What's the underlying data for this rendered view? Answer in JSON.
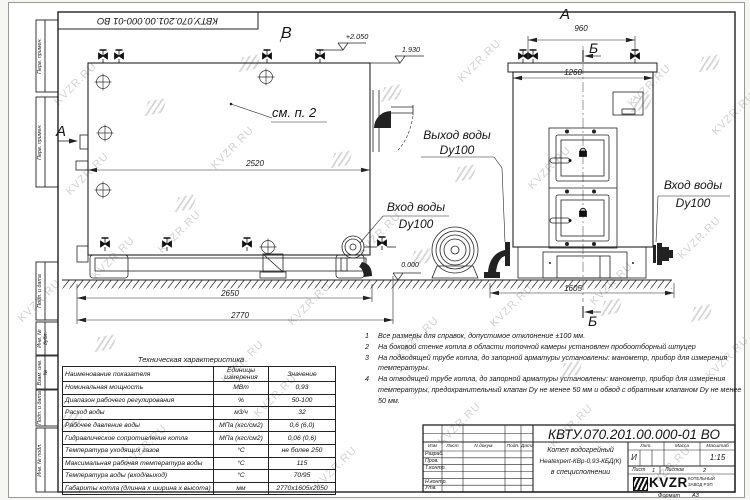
{
  "watermark": {
    "text": "KVZR.RU"
  },
  "sheet": {
    "top_stamp": "КВТУ.070.201.00.000-01 ВО",
    "margin_top": [
      "Перв. примен.",
      "Перв. примен."
    ],
    "margin_bottom": [
      "Подп. и дата",
      "Инв. № дубл.",
      "Взам. инв. №",
      "Подп. и дата",
      "Инв. № подл."
    ],
    "format_label": "Формат",
    "format_value": "А3"
  },
  "drawing": {
    "labels": {
      "view_a_left": "А",
      "view_b": "В",
      "view_a_top": "А",
      "cut_b_top": "Б",
      "cut_b_bottom": "Б",
      "see_note": "см. п. 2"
    },
    "elev": {
      "top": "+2.050",
      "mid": "1.930",
      "zero": "0.000"
    },
    "callouts": {
      "outlet_l1": "Выход воды",
      "outlet_l2": "Dy100",
      "inlet_left_l1": "Вход воды",
      "inlet_left_l2": "Dy100",
      "inlet_right_l1": "Вход воды",
      "inlet_right_l2": "Dy100"
    },
    "dims": {
      "d2520": "2520",
      "d2650": "2650",
      "d2770": "2770",
      "d960": "960",
      "d1260": "1260",
      "d1605": "1605"
    }
  },
  "notes": [
    {
      "num": "1",
      "text": "Все размеры для справок, допустимое отклонение  ±100 мм."
    },
    {
      "num": "2",
      "text": "На боковой стенке котла в области топочной камеры установлен пробоотборный штуцер"
    },
    {
      "num": "3",
      "text": "На  подводящей трубе котла, до запорной арматуры установлены: манометр, прибор для измерения температуры."
    },
    {
      "num": "4",
      "text": "На отводящей трубе котла, до запорной арматуры установлены: манометр, прибор для измерения температуры, предохранительный клапан Dу не менее 50 мм и обвод с обратным клапаном Dу не менее 50 мм."
    }
  ],
  "tech_table": {
    "title": "Техническая характеристика",
    "headers": [
      "Наименование показателя",
      "Единицы измерения",
      "Значение"
    ],
    "rows": [
      [
        "Номинальная мощность",
        "МВт",
        "0,93"
      ],
      [
        "Диапазон рабочего регулирования",
        "%",
        "50-100"
      ],
      [
        "Расход воды",
        "м3/ч",
        "32"
      ],
      [
        "Рабочее давление воды",
        "МПа (кгс/см2)",
        "0,6 (6,0)"
      ],
      [
        "Гидравлическое сопротивление котла",
        "МПа (кгс/см2)",
        "0,06 (0,6)"
      ],
      [
        "Температура уходящих газов",
        "°С",
        "не более 250"
      ],
      [
        "Максимальная рабочая температура воды",
        "°С",
        "115"
      ],
      [
        "Температура воды (вход/выход)",
        "°С",
        "70/95"
      ],
      [
        "Габариты котла (длинна х ширина х высота)",
        "мм",
        "2770х1605х2050"
      ]
    ]
  },
  "title_block": {
    "doc_number": "КВТУ.070.201.00.000-01 ВО",
    "product": [
      "Котел водогрейный",
      "Heatexpert-КВр-0,93-КБД(К)",
      "в специсполнении"
    ],
    "cols": [
      "Изм",
      "Лист",
      "N докум.",
      "Подп.",
      "Дата"
    ],
    "rows": [
      "Разраб.",
      "Пров.",
      "Т.контр.",
      "Н.контр.",
      "Утв."
    ],
    "lit_label": "Лит.",
    "lit_value": "И",
    "mass_label": "Масса",
    "scale_label": "Масштаб",
    "scale_value": "1:15",
    "sheet_label": "Лист",
    "sheet_value": "1",
    "sheets_label": "Листов",
    "sheets_value": "2",
    "logo_text": "KVZR",
    "company": [
      "КОТЕЛЬНЫЙ",
      "ЗАВОД РЭП"
    ]
  }
}
